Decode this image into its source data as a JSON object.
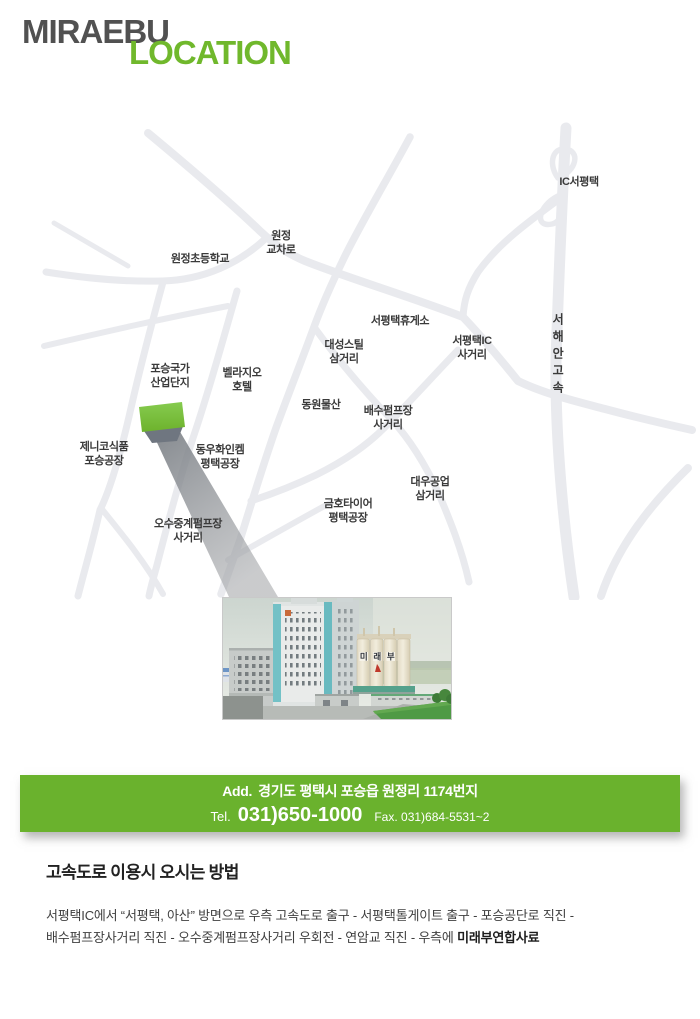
{
  "header": {
    "brand": "MIRAEBU",
    "section": "LOCATION"
  },
  "colors": {
    "accent_green": "#70b82c",
    "banner_green": "#6ab22d",
    "marker_green": "#7cc13d",
    "road_gray": "#e9eaee",
    "label_gray": "#3a3a3a"
  },
  "map": {
    "labels": [
      {
        "id": "ic-seopyeongtaek",
        "lines": [
          "IC서평택"
        ],
        "x": 579,
        "y": 182
      },
      {
        "id": "wonjeong-gyocharo",
        "lines": [
          "원정",
          "교차로"
        ],
        "x": 281,
        "y": 243
      },
      {
        "id": "wonjeong-elementary-school",
        "lines": [
          "원정초등학교"
        ],
        "x": 200,
        "y": 259
      },
      {
        "id": "seopyeongtaek-rest-area",
        "lines": [
          "서평택휴게소"
        ],
        "x": 400,
        "y": 321
      },
      {
        "id": "daeseong-steel-samgeori",
        "lines": [
          "대성스틸",
          "삼거리"
        ],
        "x": 344,
        "y": 352
      },
      {
        "id": "seopyeongtaek-ic-sageori",
        "lines": [
          "서평택IC",
          "사거리"
        ],
        "x": 472,
        "y": 348
      },
      {
        "id": "seohaean-expressway",
        "lines": [
          "서",
          "해",
          "안",
          "고",
          "속"
        ],
        "x": 558,
        "y": 354,
        "vertical": true
      },
      {
        "id": "dongwon-mulsan",
        "lines": [
          "동원물산"
        ],
        "x": 321,
        "y": 405
      },
      {
        "id": "baesu-pump-sageori",
        "lines": [
          "배수펌프장",
          "사거리"
        ],
        "x": 388,
        "y": 418
      },
      {
        "id": "poseung-national-industrial-complex",
        "lines": [
          "포승국가",
          "산업단지"
        ],
        "x": 170,
        "y": 376
      },
      {
        "id": "bellagio-hotel",
        "lines": [
          "벨라지오",
          "호텔"
        ],
        "x": 242,
        "y": 380
      },
      {
        "id": "jenico-foods-poseung",
        "lines": [
          "제니코식품",
          "포승공장"
        ],
        "x": 104,
        "y": 454
      },
      {
        "id": "dongwoo-finechem-pyeongtaek",
        "lines": [
          "동우화인켐",
          "평택공장"
        ],
        "x": 220,
        "y": 457
      },
      {
        "id": "osu-relay-pump-sageori",
        "lines": [
          "오수중계펌프장",
          "사거리"
        ],
        "x": 188,
        "y": 531
      },
      {
        "id": "daewoo-gongeop-samgeori",
        "lines": [
          "대우공업",
          "삼거리"
        ],
        "x": 430,
        "y": 489
      },
      {
        "id": "kumho-tire-pyeongtaek",
        "lines": [
          "금호타이어",
          "평택공장"
        ],
        "x": 348,
        "y": 511
      }
    ]
  },
  "photo": {
    "silo_chars": [
      "미",
      "래",
      "부"
    ]
  },
  "banner": {
    "add_label": "Add.",
    "address": "경기도 평택시 포승읍 원정리 1174번지",
    "tel_label": "Tel.",
    "tel": "031)650-1000",
    "fax_label": "Fax.",
    "fax": "031)684-5531~2"
  },
  "directions": {
    "heading": "고속도로 이용시 오시는 방법",
    "line1": "서평택IC에서 “서평택, 아산” 방면으로 우측 고속도로 출구 - 서평택톨게이트 출구 - 포승공단로 직진 -",
    "line2_prefix": "배수펌프장사거리 직진 - 오수중계펌프장사거리 우회전 - 연암교 직진 - 우측에 ",
    "line2_bold": "미래부연합사료"
  }
}
